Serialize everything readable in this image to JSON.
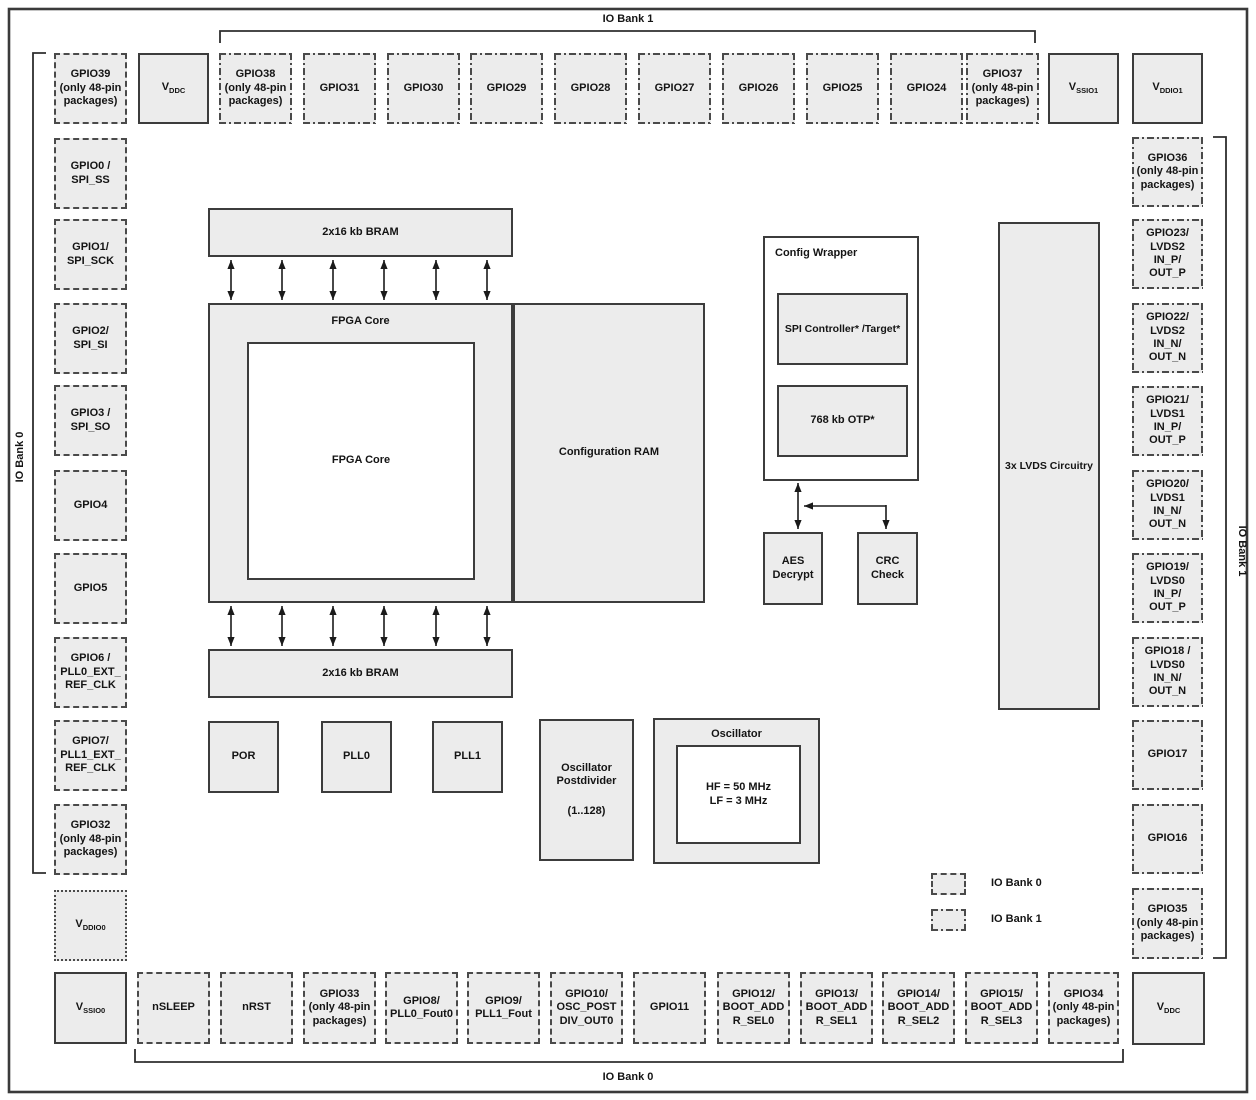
{
  "banks": {
    "top": "IO Bank 1",
    "bottom": "IO Bank 0",
    "left": "IO Bank 0",
    "right": "IO Bank 1"
  },
  "legend": {
    "bank0": "IO Bank 0",
    "bank1": "IO Bank 1"
  },
  "power": {
    "vddc_top": {
      "main": "V",
      "sub": "DDC"
    },
    "vssio1": {
      "main": "V",
      "sub": "SSIO1"
    },
    "vddio1": {
      "main": "V",
      "sub": "DDIO1"
    },
    "vddio0": {
      "main": "V",
      "sub": "DDIO0"
    },
    "vssio0": {
      "main": "V",
      "sub": "SSIO0"
    },
    "vddc_bottom": {
      "main": "V",
      "sub": "DDC"
    }
  },
  "top_row": [
    {
      "label": "GPIO39\n(only 48-pin\npackages)"
    },
    {
      "label": "GPIO38\n(only 48-pin\npackages)"
    },
    {
      "label": "GPIO31"
    },
    {
      "label": "GPIO30"
    },
    {
      "label": "GPIO29"
    },
    {
      "label": "GPIO28"
    },
    {
      "label": "GPIO27"
    },
    {
      "label": "GPIO26"
    },
    {
      "label": "GPIO25"
    },
    {
      "label": "GPIO24"
    },
    {
      "label": "GPIO37\n(only 48-pin\npackages)"
    }
  ],
  "left_col": [
    {
      "label": "GPIO0 /\nSPI_SS"
    },
    {
      "label": "GPIO1/\nSPI_SCK"
    },
    {
      "label": "GPIO2/\nSPI_SI"
    },
    {
      "label": "GPIO3 /\nSPI_SO"
    },
    {
      "label": "GPIO4"
    },
    {
      "label": "GPIO5"
    },
    {
      "label": "GPIO6 /\nPLL0_EXT_\nREF_CLK"
    },
    {
      "label": "GPIO7/\nPLL1_EXT_\nREF_CLK"
    },
    {
      "label": "GPIO32\n(only 48-pin\npackages)"
    }
  ],
  "right_col": [
    {
      "label": "GPIO36\n(only 48-pin\npackages)"
    },
    {
      "label": "GPIO23/\nLVDS2\nIN_P/\nOUT_P"
    },
    {
      "label": "GPIO22/\nLVDS2\nIN_N/\nOUT_N"
    },
    {
      "label": "GPIO21/\nLVDS1\nIN_P/\nOUT_P"
    },
    {
      "label": "GPIO20/\nLVDS1\nIN_N/\nOUT_N"
    },
    {
      "label": "GPIO19/\nLVDS0\nIN_P/\nOUT_P"
    },
    {
      "label": "GPIO18 /\nLVDS0\nIN_N/\nOUT_N"
    },
    {
      "label": "GPIO17"
    },
    {
      "label": "GPIO16"
    },
    {
      "label": "GPIO35\n(only 48-pin\npackages)"
    }
  ],
  "bottom_row": [
    {
      "label": "nSLEEP"
    },
    {
      "label": "nRST"
    },
    {
      "label": "GPIO33\n(only 48-pin\npackages)"
    },
    {
      "label": "GPIO8/\nPLL0_Fout0"
    },
    {
      "label": "GPIO9/\nPLL1_Fout"
    },
    {
      "label": "GPIO10/\nOSC_POST\nDIV_OUT0"
    },
    {
      "label": "GPIO11"
    },
    {
      "label": "GPIO12/\nBOOT_ADD\nR_SEL0"
    },
    {
      "label": "GPIO13/\nBOOT_ADD\nR_SEL1"
    },
    {
      "label": "GPIO14/\nBOOT_ADD\nR_SEL2"
    },
    {
      "label": "GPIO15/\nBOOT_ADD\nR_SEL3"
    },
    {
      "label": "GPIO34\n(only 48-pin\npackages)"
    }
  ],
  "core": {
    "bram_top": "2x16 kb BRAM",
    "bram_bottom": "2x16 kb BRAM",
    "fpga_core_outer": "FPGA Core",
    "fpga_core_inner": "FPGA Core",
    "config_ram": "Configuration RAM",
    "por": "POR",
    "pll0": "PLL0",
    "pll1": "PLL1",
    "osc_postdivider": "Oscillator\nPostdivider",
    "osc_postdivider_range": "(1..128)",
    "oscillator_title": "Oscillator",
    "oscillator_freqs": "HF = 50 MHz\nLF = 3 MHz",
    "config_wrapper_title": "Config Wrapper",
    "spi_controller": "SPI Controller* /Target*",
    "otp": "768 kb OTP*",
    "aes": "AES\nDecrypt",
    "crc": "CRC\nCheck",
    "lvds": "3x LVDS Circuitry"
  },
  "colors": {
    "box_fill": "#ececec",
    "border": "#3c3c3c",
    "text": "#141414"
  }
}
